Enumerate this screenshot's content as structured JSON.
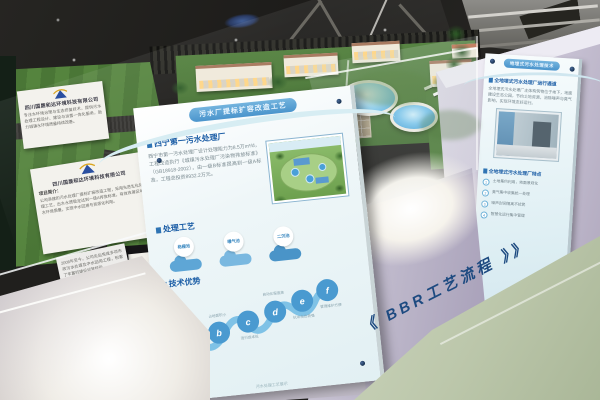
{
  "left_cards": {
    "company_name": "四川国晟和达环境科技有限公司",
    "card1_text": "专注水环境治理与生态修复技术，提供污水处理工程设计、建设与运营一体化服务，助力城镇水环境质量持续改善。",
    "intro_label": "项目简介：",
    "card2_text": "公司承建的污水处理厂提标扩容改造工程，采用先进生化处理工艺，出水水质稳定达到一级A排放标准，有效改善区域水环境质量，实现中水回用与资源化利用。",
    "card3_text": "2008年至今，公司先后完成多项市政污水处理及中水回用工程，积累了丰富的建设运营经验。"
  },
  "main_placard": {
    "banner": "污水厂提标扩容改造工艺",
    "section1": {
      "title": "西宁第一污水处理厂",
      "body": "西宁市第一污水处理厂设计处理能力为8.5万m³/d，工程改造执行《城镇污水处理厂污染物排放标准》（GB18918-2002），由一级B标准提高到一级A标准，工程总投资8932.2万元。"
    },
    "section2": {
      "title": "处理工艺",
      "steps": [
        {
          "name": "格栅池"
        },
        {
          "name": "曝气池"
        },
        {
          "name": "二沉池"
        }
      ]
    },
    "section3": {
      "title": "技术优势",
      "items": [
        {
          "letter": "a",
          "label": "出水水质稳定"
        },
        {
          "letter": "b",
          "label": "占地面积小"
        },
        {
          "letter": "c",
          "label": "运行成本低"
        },
        {
          "letter": "d",
          "label": "自动化程度高"
        },
        {
          "letter": "e",
          "label": "抗冲击负荷强"
        },
        {
          "letter": "f",
          "label": "管理维护方便"
        }
      ]
    },
    "footer_note": "污水处理工艺展示"
  },
  "right_placard": {
    "banner": "地埋式污水处理技术",
    "section1": {
      "title": "全地埋式污水处理厂运行通道",
      "body": "全地埋式污水处理厂主体构筑物位于地下，地面建设生态公园，节约土地资源，消除噪声与臭气影响，实现环境友好运行。"
    },
    "section2": {
      "title": "全地埋式污水处理厂特点",
      "items": [
        {
          "label": "土地集约利用，地面景观化"
        },
        {
          "label": "臭气集中收集统一处理"
        },
        {
          "label": "噪声封闭隔离不扰民"
        },
        {
          "label": "智慧化运行集中管理"
        }
      ]
    }
  },
  "floor_text": "《 BBR工艺流程 》》"
}
